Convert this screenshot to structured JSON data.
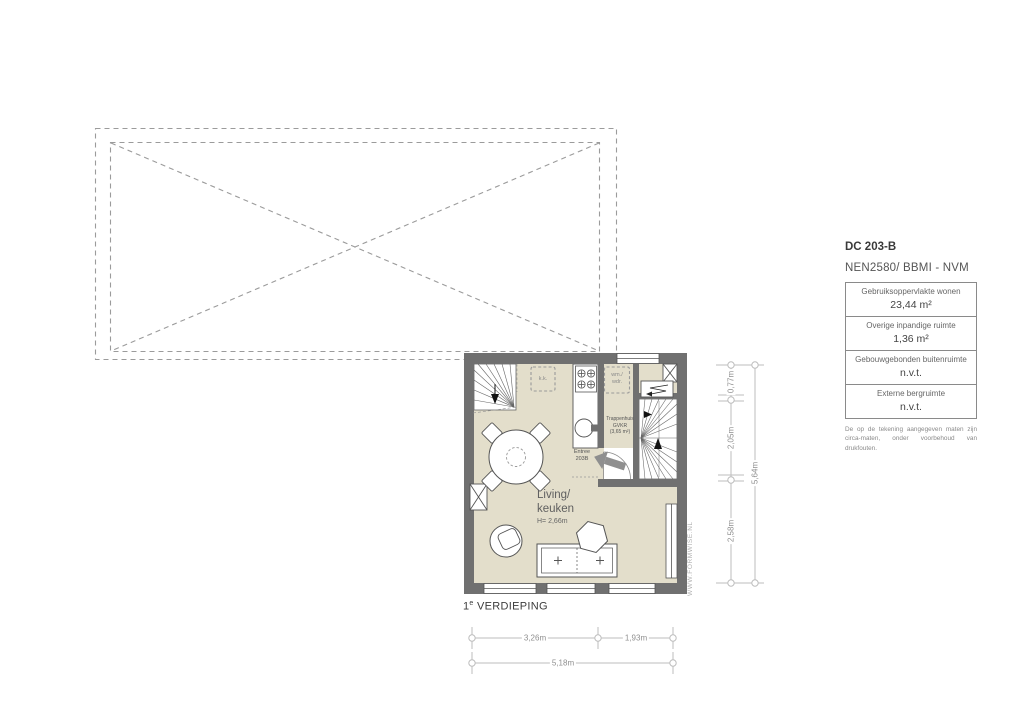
{
  "info_panel": {
    "code": "DC 203-B",
    "standard": "NEN2580/ BBMI - NVM",
    "rows": [
      {
        "label": "Gebruiksoppervlakte wonen",
        "value": "23,44 m²"
      },
      {
        "label": "Overige inpandige ruimte",
        "value": "1,36 m²"
      },
      {
        "label": "Gebouwgebonden buitenruimte",
        "value": "n.v.t."
      },
      {
        "label": "Externe bergruimte",
        "value": "n.v.t."
      }
    ],
    "disclaimer": "De op de tekening aangegeven maten zijn circa-maten, onder voorbehoud van drukfouten."
  },
  "title": {
    "num": "1",
    "sup": "e",
    "rest": " VERDIEPING"
  },
  "floor_plan": {
    "room_label_line1": "Living/",
    "room_label_line2": "keuken",
    "room_height": "H= 2,66m",
    "stairwell_line1": "Trappenhuis",
    "stairwell_line2": "GVKR",
    "stairwell_line3": "(3,65 m²)",
    "entree_line1": "Entree",
    "entree_line2": "203B",
    "kk_label": "k.k.",
    "wm_line1": "wm./",
    "wm_line2": "wdr.",
    "watermark": "WWW.FORMWISE.NL"
  },
  "dimensions": {
    "right": [
      "0,77m",
      "2,05m",
      "2,58m",
      "5,64m"
    ],
    "bottom": [
      "3,26m",
      "1,93m",
      "5,18m"
    ]
  },
  "colors": {
    "floor": "#e3decb",
    "wall": "#707070",
    "dashed_outline": "#9b9b9b",
    "dimension": "#b5b5b5",
    "arrow": "#8f8f8f"
  }
}
